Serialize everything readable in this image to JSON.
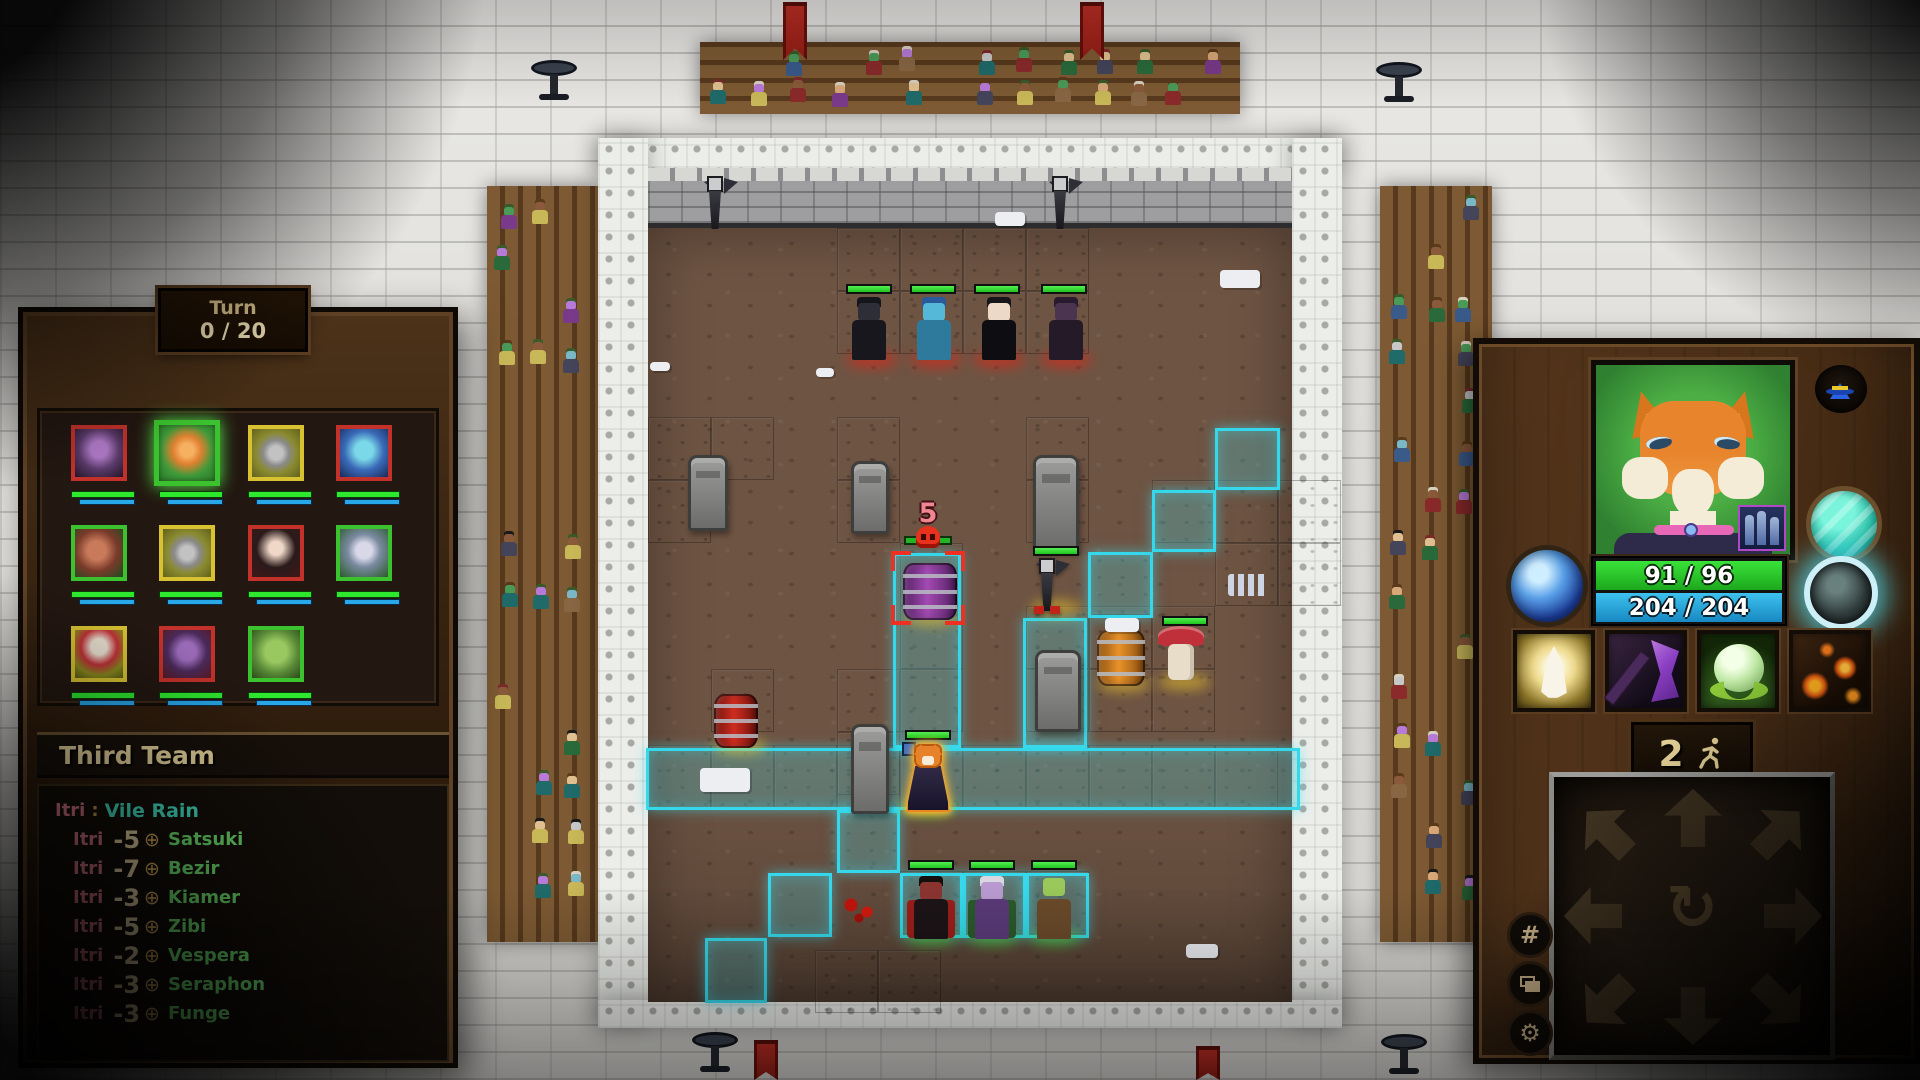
{
  "turn_panel": {
    "label": "Turn",
    "value": "0 / 20"
  },
  "roster": {
    "title": "Third Team",
    "portraits": [
      {
        "name": "purple-feline",
        "frame": "red",
        "selected": false
      },
      {
        "name": "fox-hero",
        "frame": "green",
        "selected": true
      },
      {
        "name": "gray-bat",
        "frame": "yellow",
        "selected": false
      },
      {
        "name": "blue-naga",
        "frame": "red",
        "selected": false
      },
      {
        "name": "horned-demoness",
        "frame": "green",
        "selected": false
      },
      {
        "name": "gray-bat-2",
        "frame": "yellow",
        "selected": false
      },
      {
        "name": "dark-haired-woman",
        "frame": "red",
        "selected": false
      },
      {
        "name": "pale-elf",
        "frame": "green",
        "selected": false
      },
      {
        "name": "mushroom-man",
        "frame": "yellow",
        "selected": false
      },
      {
        "name": "purple-demoness",
        "frame": "red",
        "selected": false
      },
      {
        "name": "green-orc",
        "frame": "green",
        "selected": false
      }
    ]
  },
  "combat_log": {
    "header": {
      "caster": "Itri",
      "separator": ":",
      "ability": "Vile Rain"
    },
    "target_icon": "crosshair-icon",
    "entries": [
      {
        "caster": "Itri",
        "amount": "-5",
        "target": "Satsuki"
      },
      {
        "caster": "Itri",
        "amount": "-7",
        "target": "Bezir"
      },
      {
        "caster": "Itri",
        "amount": "-3",
        "target": "Kiamer"
      },
      {
        "caster": "Itri",
        "amount": "-5",
        "target": "Zibi"
      },
      {
        "caster": "Itri",
        "amount": "-2",
        "target": "Vespera"
      },
      {
        "caster": "Itri",
        "amount": "-3",
        "target": "Seraphon"
      },
      {
        "caster": "Itri",
        "amount": "-3",
        "target": "Funge"
      }
    ]
  },
  "battlefield": {
    "enemy_counter": "5"
  },
  "hero_panel": {
    "hp": "91 / 96",
    "mana": "204 / 204",
    "moves_left": "2",
    "abilities": [
      {
        "name": "healing-prayer"
      },
      {
        "name": "shadow-axe"
      },
      {
        "name": "life-orb"
      },
      {
        "name": "lava-burst"
      }
    ],
    "buttons": {
      "hat": "wizard-hat-icon",
      "grid": "#",
      "rotate": "↻",
      "gear": "⚙"
    }
  },
  "colors": {
    "accent_cyan": "#35d8ea",
    "hp_green": "#35e83a",
    "mana_blue": "#28a8e8",
    "frame_red": "#c2322a",
    "frame_yellow": "#d8c232",
    "frame_green": "#3cc22e",
    "log_caster": "#e0798c",
    "log_ability": "#44e8c8",
    "log_amount": "#ecd9a8",
    "log_target": "#72e872"
  }
}
